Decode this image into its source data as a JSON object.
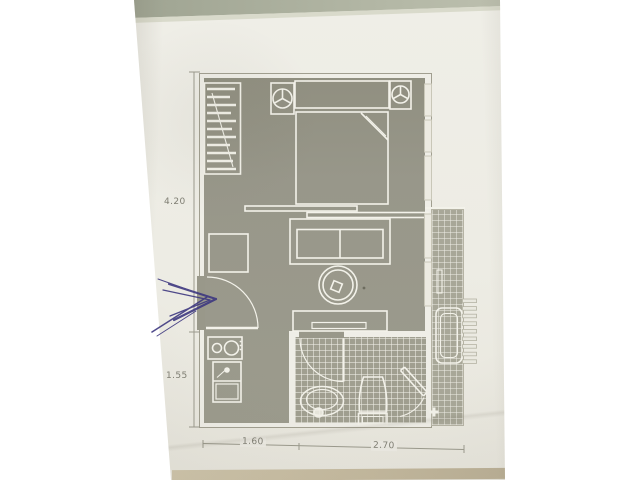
{
  "document": {
    "kind": "photographed architectural floor plan on paper",
    "dimension_labels": {
      "height_upper": "4.20",
      "height_lower": "1.55",
      "width_left": "1.60",
      "width_right": "2.70"
    },
    "rooms": [
      "bedroom",
      "living-area",
      "entry",
      "kitchenette",
      "bathroom",
      "balcony",
      "wardrobe"
    ],
    "symbols": [
      "wardrobe-rail",
      "double-bed",
      "nightstand-lamp-left",
      "nightstand-lamp-right",
      "sliding-partition",
      "window-panes",
      "sofa",
      "side-table",
      "round-table",
      "tv-lowboard",
      "entry-door-swing",
      "cooktop",
      "kitchen-sink",
      "bath-door-swing",
      "washbasin",
      "toilet",
      "shower-door",
      "floor-drain",
      "lounge-chair",
      "balcony-railing"
    ],
    "annotation": {
      "type": "hand-drawn pen chevron pointing at entry door",
      "color": "#3e3880"
    },
    "palette": {
      "paper": "#edece4",
      "floor_fill": "#99988a",
      "tile_fill": "#a09f90",
      "plan_line": "#f3f2ea",
      "dimension_line": "#9b9a8d",
      "table_top": "#aab09c",
      "table_edge": "#c7bda2"
    }
  }
}
